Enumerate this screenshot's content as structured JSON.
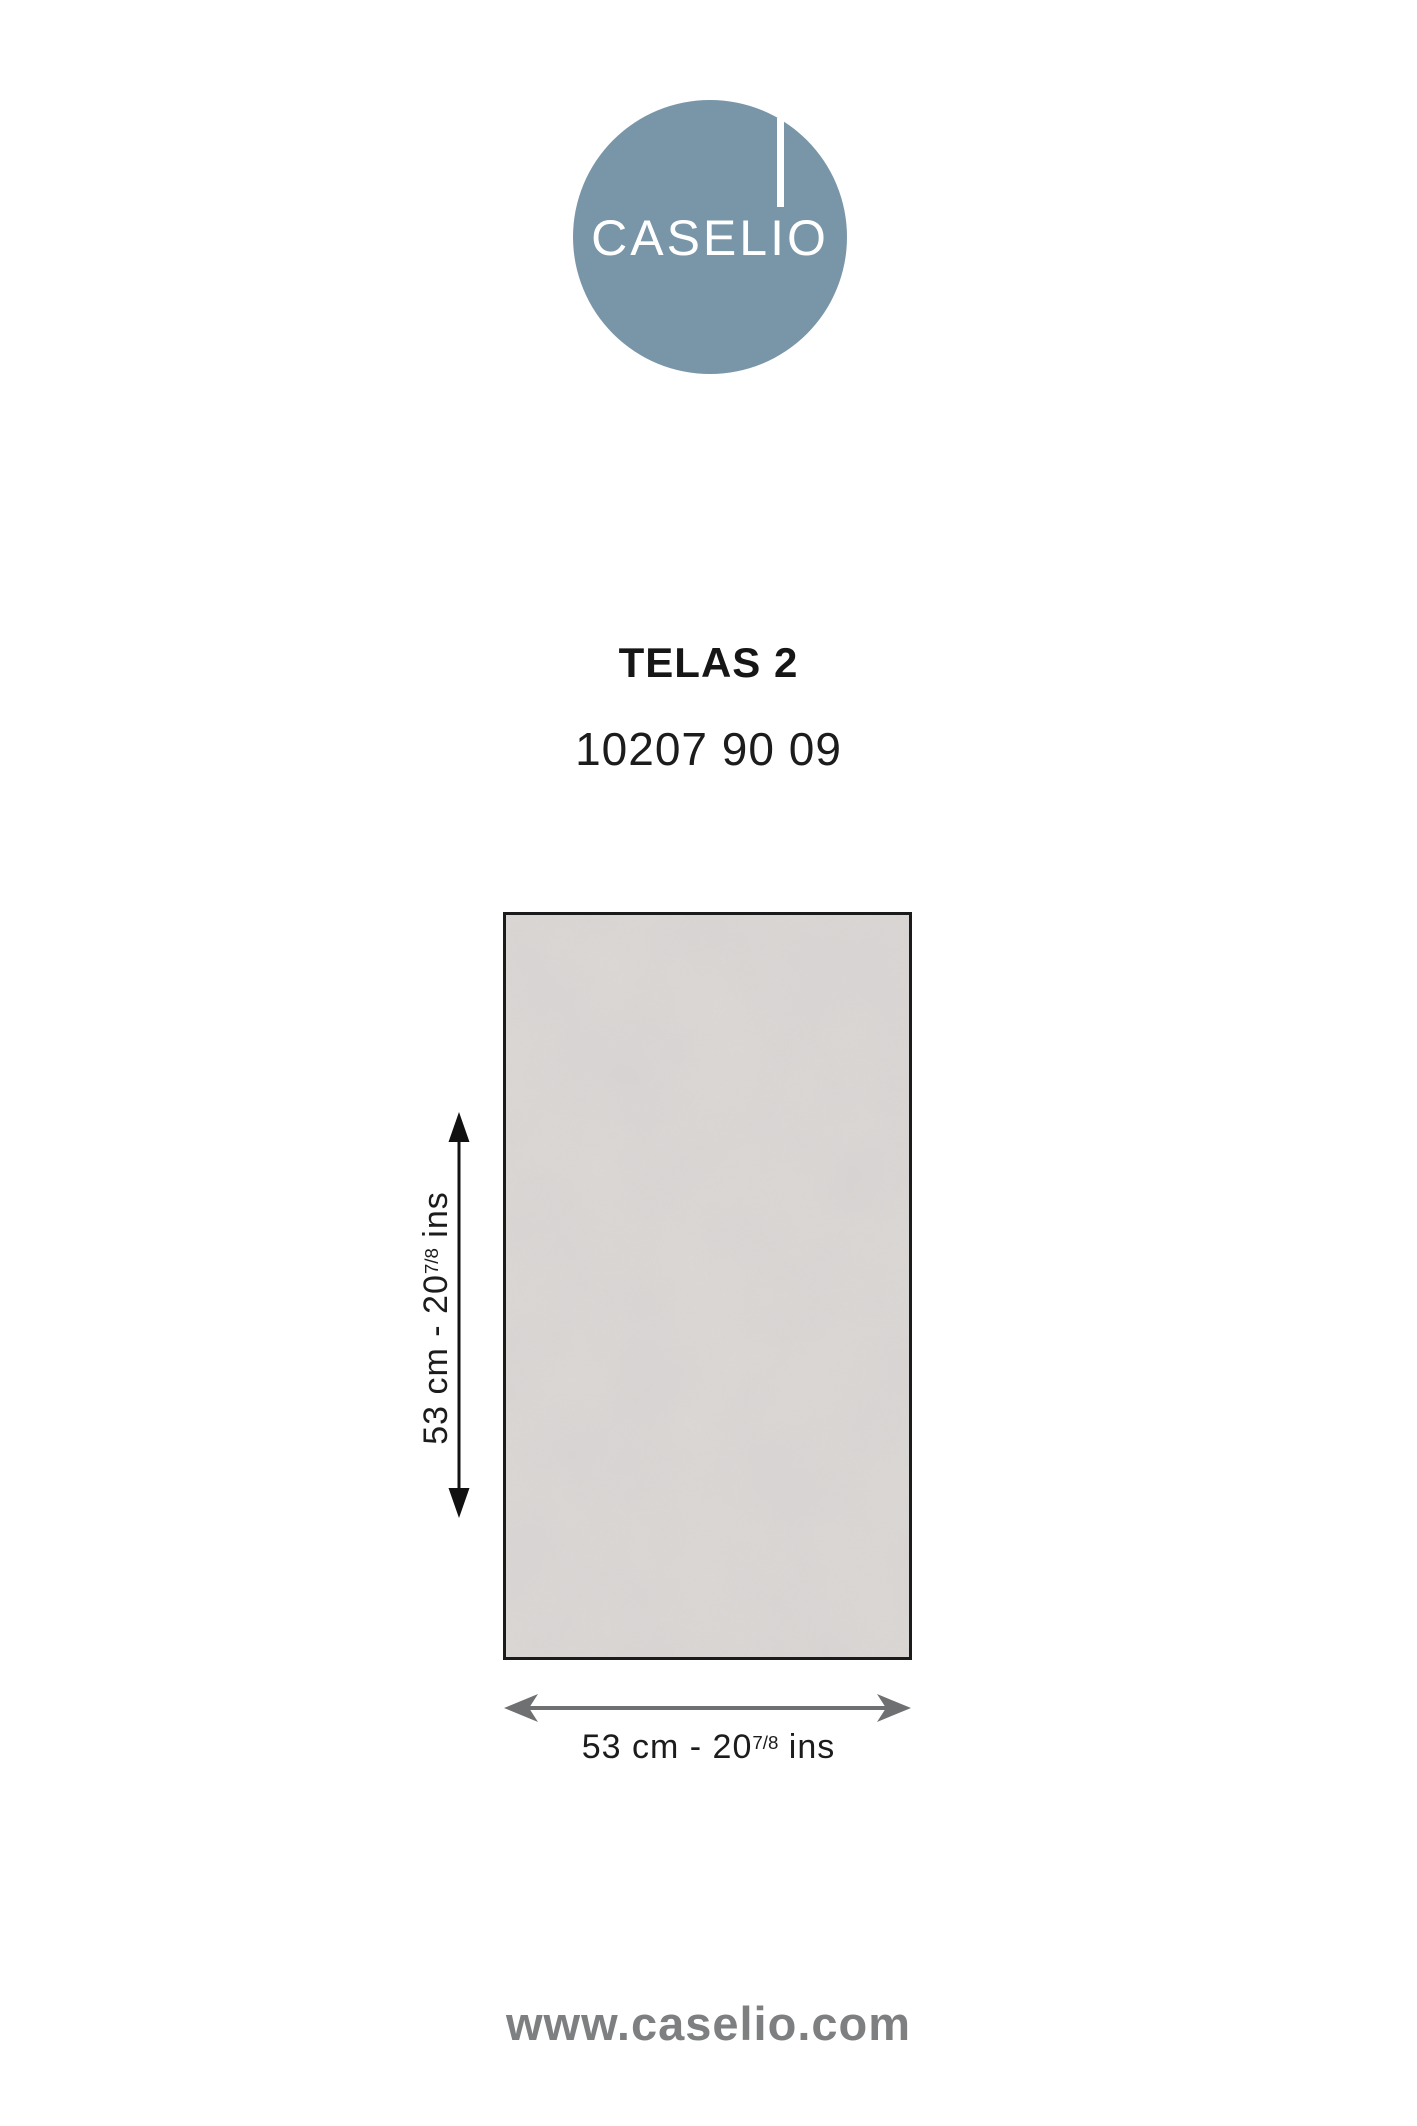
{
  "logo": {
    "brand": "CASELIO",
    "circle_color": "#7996a9",
    "text_color": "#ffffff"
  },
  "product": {
    "collection": "TELAS 2",
    "reference": "10207 90 09"
  },
  "swatch": {
    "description": "plain textured wallpaper sample, mottled light grey canvas weave",
    "base_color": "#d9d6d3",
    "texture_color": "#b5b0ae",
    "border_color": "#1b1b1b"
  },
  "dimensions": {
    "height_label": {
      "prefix": "53 cm - 20",
      "fraction": "7/8",
      "suffix": " ins"
    },
    "width_label": {
      "prefix": "53 cm - 20",
      "fraction": "7/8",
      "suffix": " ins"
    },
    "vertical_arrow_color": "#111111",
    "horizontal_arrow_color": "#6f7072"
  },
  "footer": {
    "website": "www.caselio.com",
    "color": "#7d7f80"
  }
}
